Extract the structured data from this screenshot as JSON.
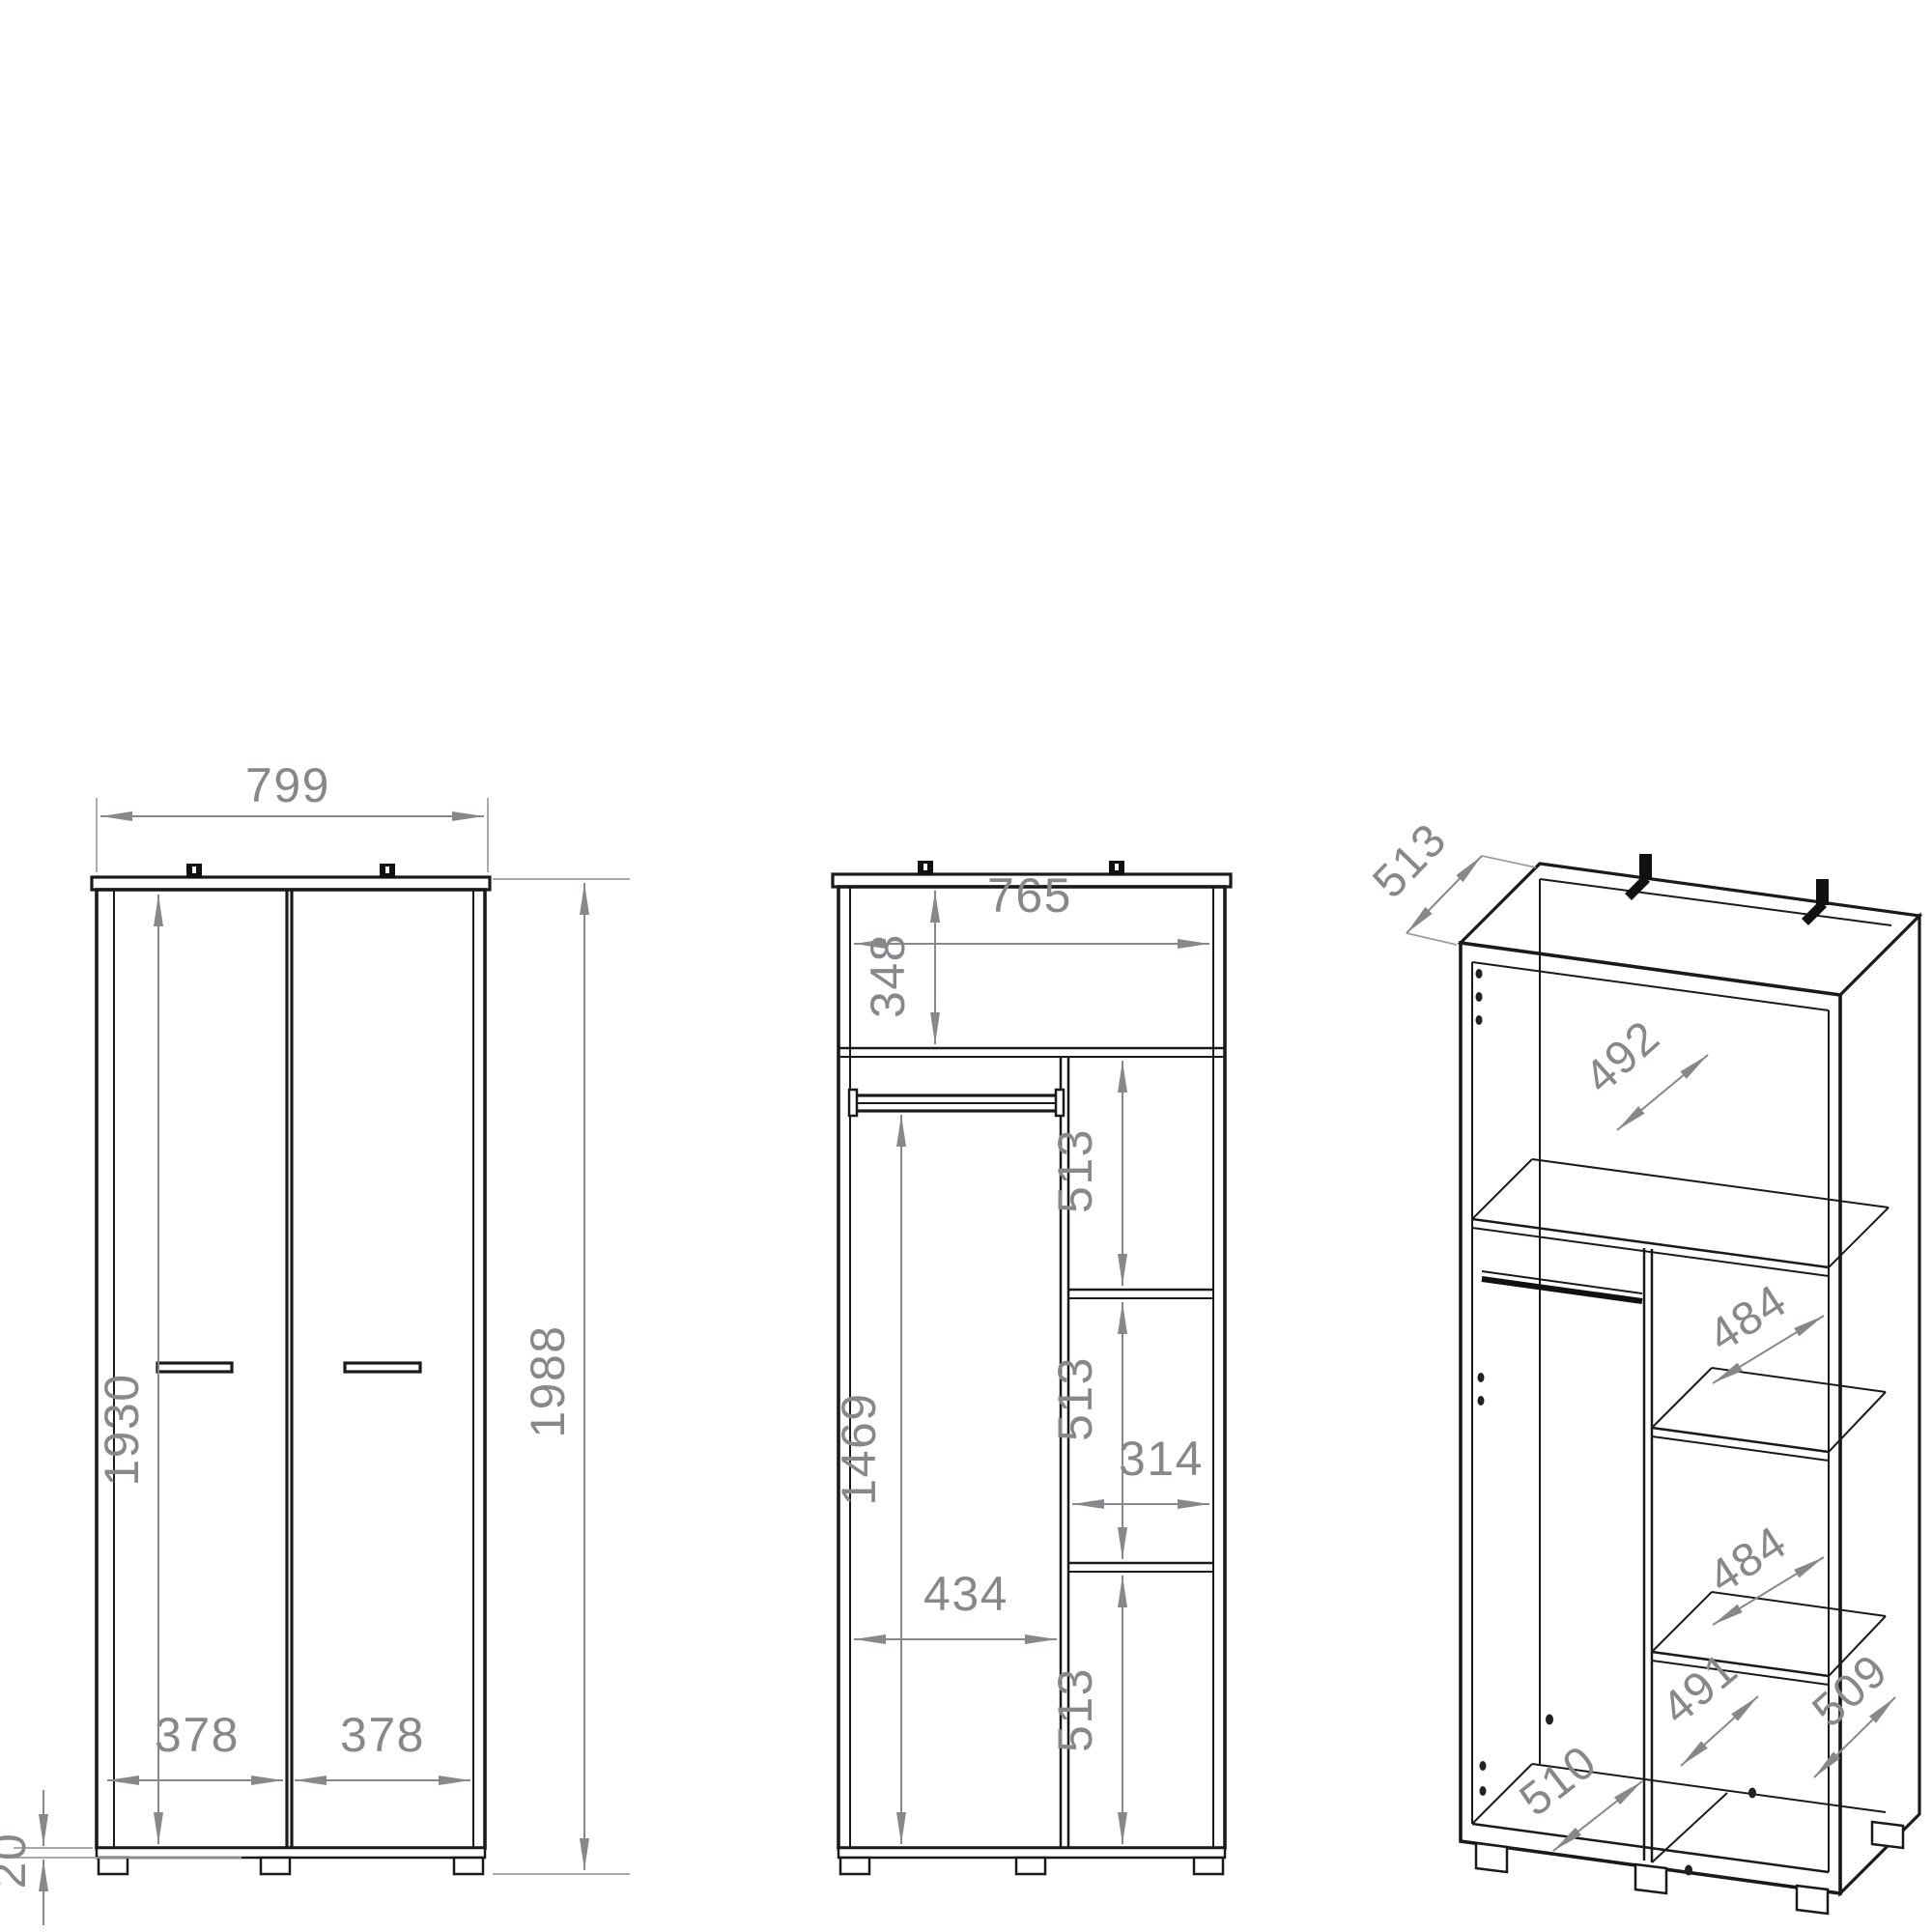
{
  "drawing_type": "wardrobe technical dimension drawing",
  "units": "mm",
  "colors": {
    "line": "#1a1a1a",
    "dimension": "#85898c",
    "background": "#ffffff",
    "hardware": "#111111"
  },
  "views": {
    "front": {
      "name": "front view, doors closed",
      "labels": {
        "width": "799",
        "height": "1988",
        "door_height": "1930",
        "left_door_width": "378",
        "right_door_width": "378",
        "plinth_height": "20"
      }
    },
    "interior": {
      "name": "front view, interior layout",
      "labels": {
        "inner_width": "765",
        "top_compartment_height": "348",
        "shelf_gap_1": "513",
        "shelf_gap_2": "513",
        "right_inner_width": "314",
        "shelf_gap_3": "513",
        "rail_drop": "1469",
        "left_inner_width": "434"
      }
    },
    "isometric": {
      "name": "isometric view",
      "labels": {
        "depth": "513",
        "top_shelf_depth": "492",
        "upper_shelf_depth": "484",
        "lower_shelf_depth": "484",
        "divider_depth": "491",
        "bottom_panel_depth": "510",
        "side_panel_depth": "509"
      }
    }
  }
}
